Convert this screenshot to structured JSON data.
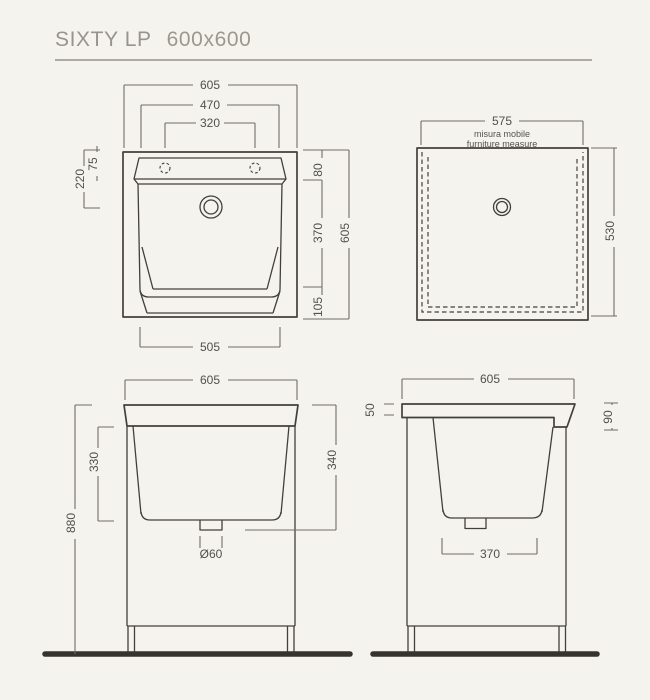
{
  "page": {
    "title_model": "SIXTY LP",
    "title_size": "600x600"
  },
  "colors": {
    "background": "#f4f3ee",
    "line": "#43403a",
    "dim_line": "#716d64",
    "dim_text": "#52504a",
    "title_text": "#96948c",
    "ground": "#36332d"
  },
  "drawings": {
    "basin_top_view": {
      "dim_overall_width_top": "605",
      "dim_ledge_width": "470",
      "dim_tapholes_span": "320",
      "dim_left_ledge_depth": "75",
      "dim_left_depth": "220",
      "dim_right_top": "80",
      "dim_right_middle": "370",
      "dim_right_bottom": "105",
      "dim_right_overall": "605",
      "dim_bottom_width": "505"
    },
    "cabinet_top_view": {
      "dim_width": "575",
      "note_italian": "misura mobile",
      "note_english": "furniture measure",
      "dim_depth": "530"
    },
    "front_view": {
      "dim_width": "605",
      "dim_basin_depth": "330",
      "dim_total_height": "880",
      "dim_height_to_drain": "340",
      "dim_drain_diameter": "Ø60"
    },
    "side_view": {
      "dim_width": "605",
      "dim_top_thickness": "50",
      "dim_front_edge_height": "90",
      "dim_basin_bottom_width": "370"
    }
  }
}
